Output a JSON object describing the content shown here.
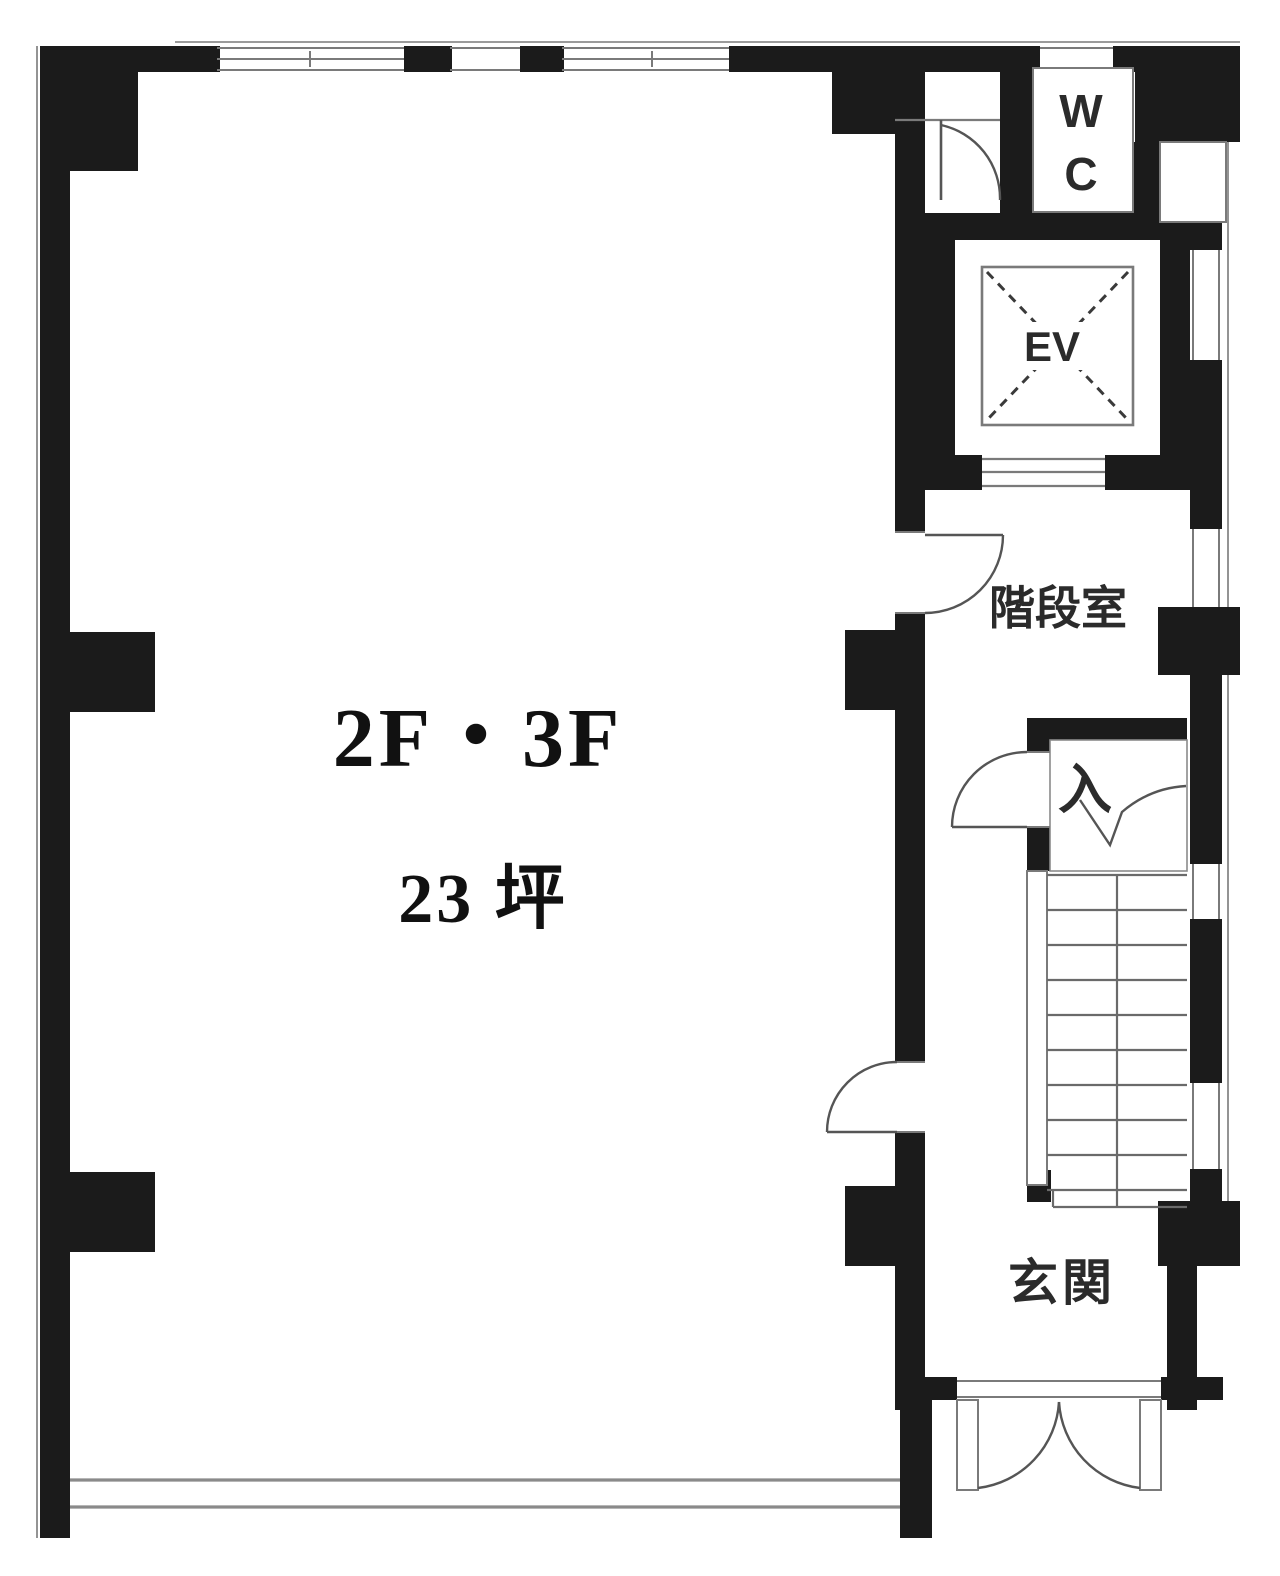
{
  "plan": {
    "floor_label": "2F・3F",
    "area_label": "23 坪",
    "labels": {
      "wc_line1": "W",
      "wc_line2": "C",
      "elevator": "EV",
      "stairwell": "階段室",
      "entry": "入",
      "entrance": "玄関"
    },
    "colors": {
      "wall": "#1b1b1b",
      "line": "#7a7a7a",
      "door": "#555555",
      "background": "#ffffff",
      "text": "#2b2b2b"
    }
  }
}
